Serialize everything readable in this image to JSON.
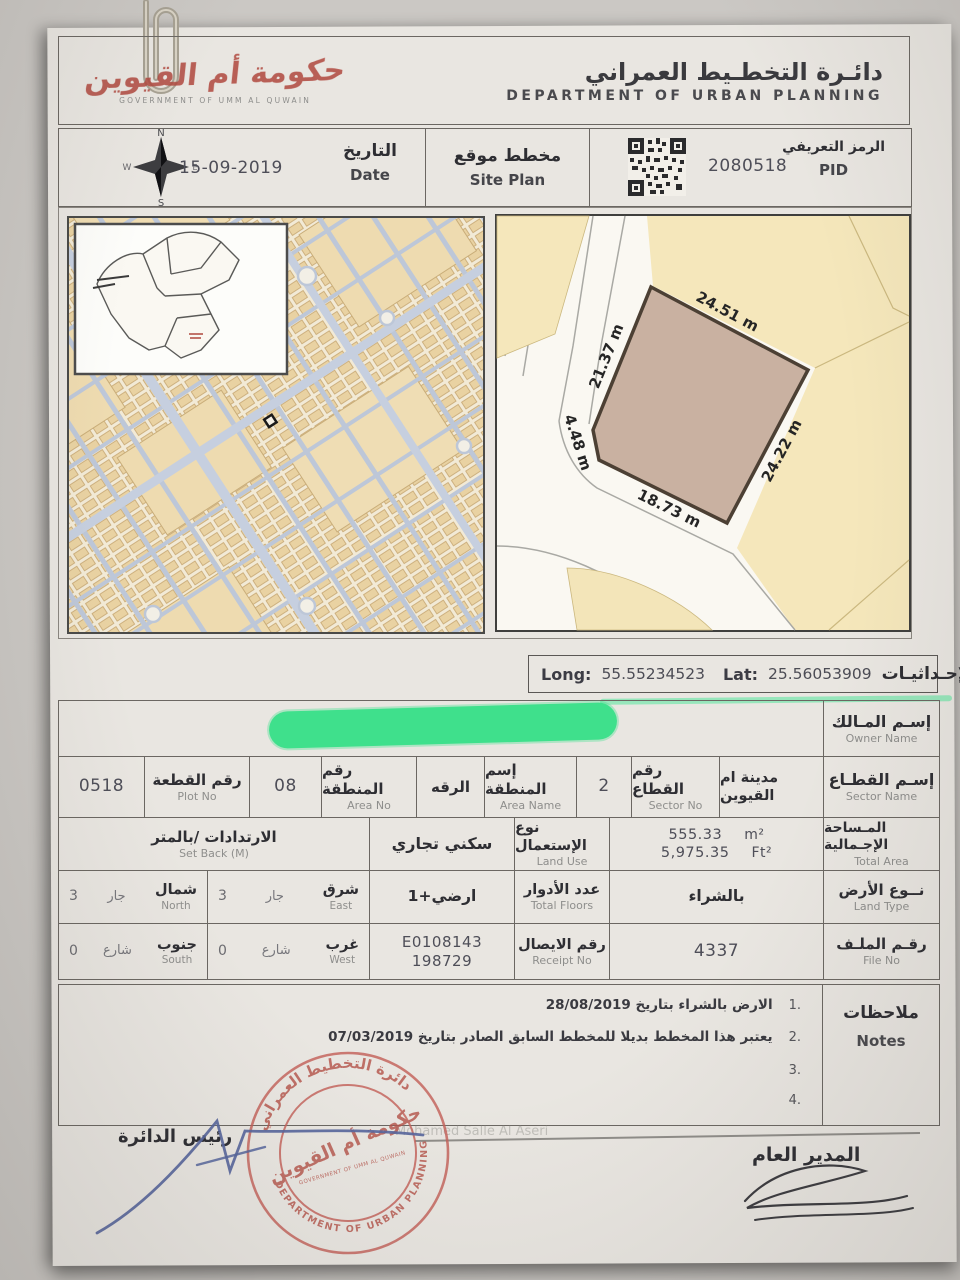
{
  "header": {
    "logo_ar": "حكومة أم القيوين",
    "logo_en": "GOVERNMENT OF UMM AL QUWAIN",
    "dept_ar": "دائـرة التخطـيط العمراني",
    "dept_en": "DEPARTMENT OF URBAN PLANNING"
  },
  "meta": {
    "date_value": "15-09-2019",
    "date_label_ar": "التاريخ",
    "date_label_en": "Date",
    "doc_ar": "مخطط موقع",
    "doc_en": "Site Plan",
    "pid_value": "2080518",
    "pid_label_ar": "الرمز التعريفي",
    "pid_label_en": "PID",
    "compass": {
      "n": "N",
      "s": "S",
      "e": "E",
      "w": "W"
    }
  },
  "site_plan": {
    "dim_top": "24.51 m",
    "dim_right": "24.22 m",
    "dim_bottom": "18.73 m",
    "dim_chamfer": "4.48 m",
    "dim_left": "21.37 m"
  },
  "coords": {
    "long_label": "Long:",
    "long_value": "55.55234523",
    "lat_label": "Lat:",
    "lat_value": "25.56053909",
    "label_ar": "الإحـداثيـات"
  },
  "table": {
    "owner": {
      "label_ar": "إسـم المـالك",
      "label_en": "Owner Name"
    },
    "plot_no": {
      "value": "0518",
      "label_ar": "رقم القطعة",
      "label_en": "Plot No"
    },
    "area_no": {
      "value": "08",
      "label_ar": "رقم المنطقة",
      "label_en": "Area No"
    },
    "area_name": {
      "value": "الرقه",
      "label_ar": "إسم المنطقة",
      "label_en": "Area Name"
    },
    "sector_no": {
      "value": "2",
      "label_ar": "رقم القطاع",
      "label_en": "Sector No"
    },
    "sector_name": {
      "value": "مدينة ام القيوين",
      "label_ar": "إسـم القطـاع",
      "label_en": "Sector Name"
    },
    "setback": {
      "label_ar": "الارتدادات /بالمتر",
      "label_en": "Set Back (M)"
    },
    "land_use": {
      "value": "سكني تجاري",
      "label_ar": "نوع الإستعمال",
      "label_en": "Land Use"
    },
    "total_area": {
      "m2_value": "555.33",
      "m2_unit": "m²",
      "ft2_value": "5,975.35",
      "ft2_unit": "Ft²",
      "label_ar": "المـساحة الإجـمالية",
      "label_en": "Total Area"
    },
    "north": {
      "label_ar": "شمال",
      "label_en": "North",
      "adj": "جار",
      "value": "3"
    },
    "east": {
      "label_ar": "شرق",
      "label_en": "East",
      "adj": "جار",
      "value": "3"
    },
    "south": {
      "label_ar": "جنوب",
      "label_en": "South",
      "adj": "شارع",
      "value": "0"
    },
    "west": {
      "label_ar": "غرب",
      "label_en": "West",
      "adj": "شارع",
      "value": "0"
    },
    "floors": {
      "value": "ارضي+1",
      "label_ar": "عدد الأدوار",
      "label_en": "Total Floors"
    },
    "land_type": {
      "value": "بالشراء",
      "label_ar": "نــوع الأرض",
      "label_en": "Land Type"
    },
    "receipt": {
      "value_line1": "E0108143",
      "value_line2": "198729",
      "label_ar": "رقم الايصال",
      "label_en": "Receipt No"
    },
    "file_no": {
      "value": "4337",
      "label_ar": "رقـم الملـف",
      "label_en": "File No"
    }
  },
  "notes": {
    "label_ar": "ملاحظات",
    "label_en": "Notes",
    "items": [
      {
        "num": "1.",
        "text": "الارض بالشراء بتاريخ 28/08/2019"
      },
      {
        "num": "2.",
        "text": "يعتبر هذا المخطط بديلا للمخطط السابق الصادر بتاريخ 07/03/2019"
      },
      {
        "num": "3.",
        "text": ""
      },
      {
        "num": "4.",
        "text": ""
      }
    ]
  },
  "footer": {
    "left_title": "رئيس الدائرة",
    "right_title": "المدير العام",
    "faint_name": "Mohamed Salle Al Aseri"
  },
  "stamp": {
    "ring_top_ar": "دائرة التخطيط العمراني",
    "ring_bottom_en": "DEPARTMENT OF URBAN PLANNING",
    "center_ar": "حكومة أم القيوين",
    "center_en": "GOVERNMENT OF UMM AL QUWAIN"
  },
  "colors": {
    "accent_red": "#b0483e",
    "redaction_green": "#3fe08c",
    "signature_blue": "#56659c"
  }
}
